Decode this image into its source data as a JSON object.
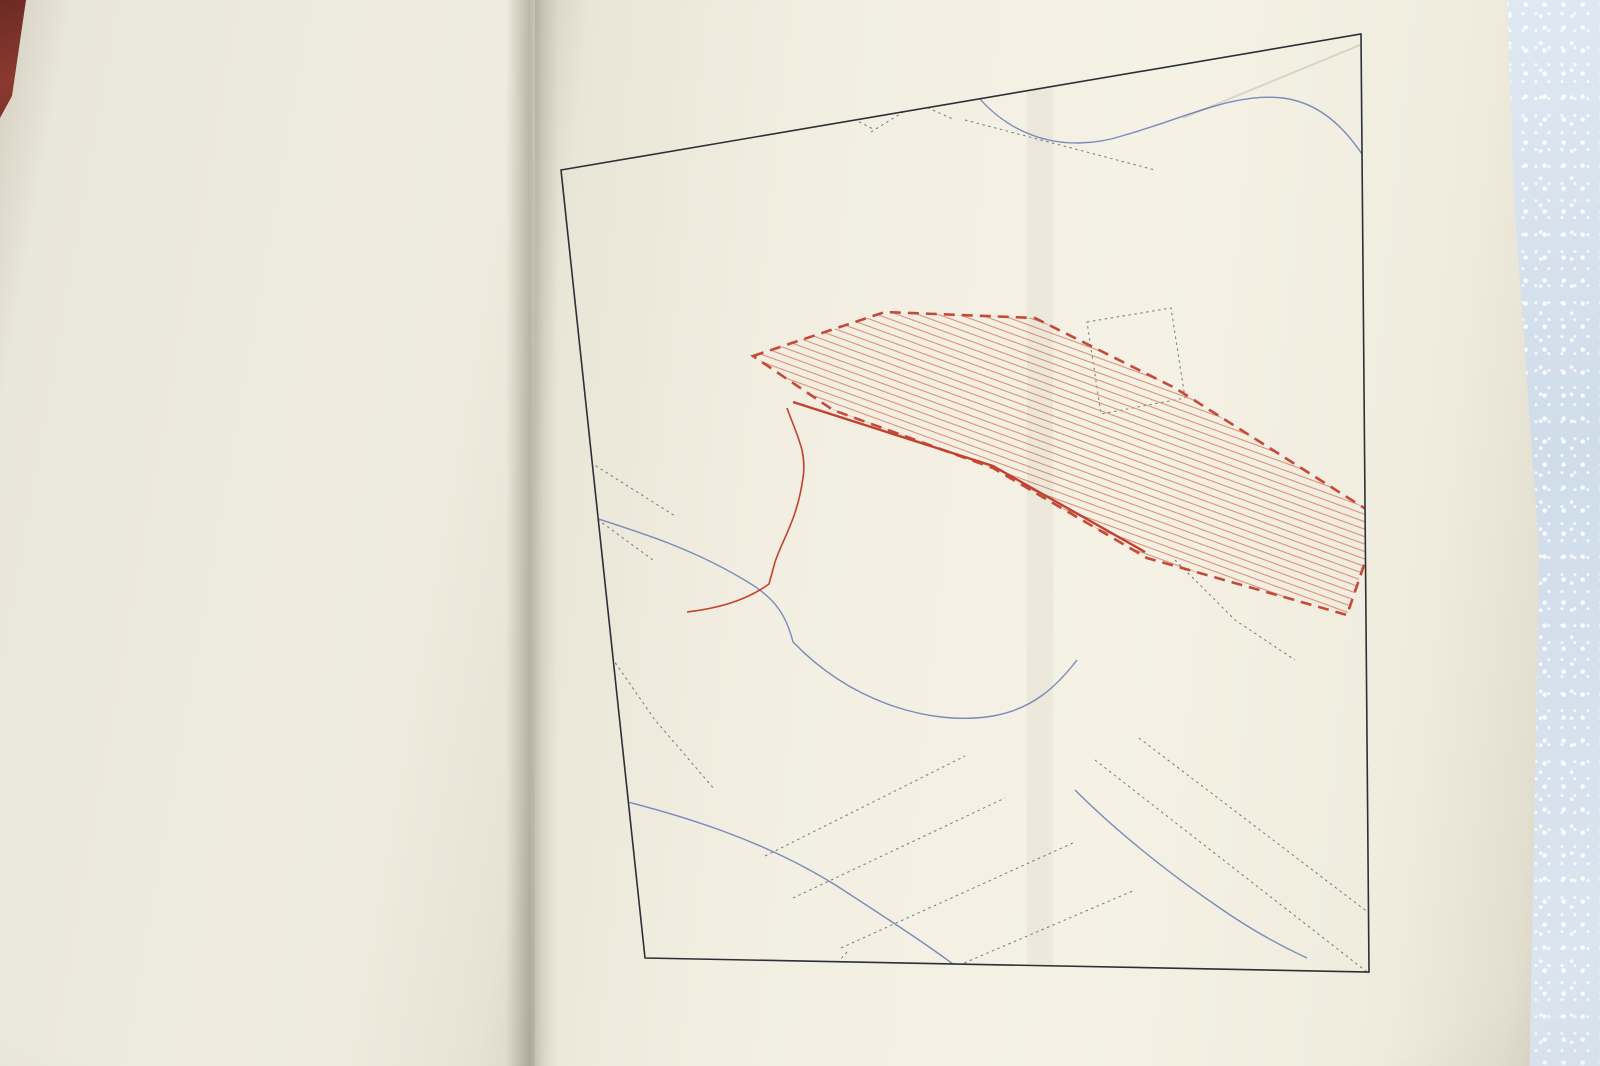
{
  "left_page": {
    "fragments": [
      {
        "t": "perméables des lass",
        "x": 372,
        "y": -2,
        "r": -25
      },
      {
        "t": "pluie tombant, par seconde, sur",
        "x": 282,
        "y": 12,
        "r": -21
      },
      {
        "t": "par cette réduction au 1/3, ou lieu",
        "x": 216,
        "y": 40,
        "r": -18
      },
      {
        "t": "une première partie de l’eau s’évapore et rem",
        "x": 74,
        "y": 46,
        "r": -13
      }
    ],
    "lines": [
      "tmosphère ou sert à la nutrition des végétaux ; de ce qu",
      "conde abreuve la terre, la traverse jusqu’à la couche imperm",
      "r laquelle elle coule pour aller dans les parties basses for",
      "s sources plus ou moins abondantes suivant l’étendue des l",
      "ns qui les alimentent ; de ce qu’enfin une troisième v′ s’éc",
      "la surface du sol dont elle gagne les points bas, en arriv",
      "core à l’égout après la fin de l’orage ; l’écoulement de la pl",
      "re, en effet, plus longtemps que sa chute.",
      "Quant aux parties imperméables, elles sont censées donner l",
      "volume d’eau v″ qu’elles reçoivent.",
      "C’est donc aux volumes réunis v′ et v″ des eaux coulant",
      "rface du sol qu’il importe de livrer passage dans les ouvra",
      "nstruire.",
      "Mais nous devons faire remarquer que, dans les questions d",
      "nre, tous les éléments d’appréciation ne sont pas faciles à",
      "ître et qu’il faut bien s’en rapporter à des observations g",
      "les pour calculer la section des égouts."
    ],
    "heading_lead": "Égout principal.",
    "heading_rest": " — Dans le cas qui nous occupe, le volum",
    "line_v": "eau total à évacuer par seconde V = v′ + v″ se calculera com",
    "line_suit": "suit :",
    "formula": {
      "lead_eq": "=",
      "brace": "{",
      "close_brace": "}",
      "rows": [
        [
          {
            "frac": [
              [
                "0",
                {
                  "sup": "mc"
                },
                ",133 × ",
                {
                  "i": "s"
                }
              ],
              [
                "3"
              ]
            ]
          },
          "  =  ",
          {
            "frac": [
              [
                "0",
                {
                  "sup": "mc"
                },
                ",133 × 6",
                {
                  "sup": "h"
                }
              ],
              [
                "3"
              ]
            ]
          },
          "  =  0",
          {
            "sup": "mc"
          },
          ",266"
        ],
        [
          "0",
          {
            "sup": "mc"
          },
          ",133 × ",
          {
            "i": "s′"
          },
          "  =  0",
          {
            "sup": "mc"
          },
          ",133 × 1",
          {
            "sup": "h"
          },
          "  =  0",
          {
            "sup": "mc"
          },
          ",133"
        ],
        [
          "0",
          {
            "sup": "mc"
          },
          ",133 × ",
          {
            "i": "s″"
          },
          "  =  0",
          {
            "sup": "mc"
          },
          ",133 × 1",
          {
            "sup": "h"
          },
          "  =  0",
          {
            "sup": "mc"
          },
          ",133  ["
        ]
      ],
      "annotations": {
        "right1": [
          "0",
          {
            "sup": "mc"
          },
          ",399 pour le côté gau"
        ],
        "right2": [
          "0",
          {
            "sup": "mc"
          },
          ",133 pour le côté dro"
        ],
        "total_label": "Volume total : V = ",
        "total_value": [
          "0",
          {
            "sup": "mc"
          },
          ",532"
        ]
      }
    },
    "bottom_lines": {
      "s1": "Supposons que l’égout soit de forme ovoïde et présen",
      "s2": "nensions cotées au croquis (fig. 37) :",
      "s3": [
        "la section supposée mouillée ",
        {
          "i": "adg"
        },
        " = 0",
        {
          "sup": "mq"
        },
        ",553 ;"
      ],
      "s4": [
        "le périmètre mouillé ",
        {
          "i": "abcdefg"
        },
        " = 2",
        {
          "sup": "m"
        },
        ",280 ;"
      ],
      "s5": [
        "=  ",
        {
          "frac": [
            [
              "0",
              {
                "sup": "mq"
              },
              ",553"
            ],
            [
              "2",
              {
                "sup": "m"
              },
              ",280"
            ]
          ]
        },
        "  =  0",
        {
          "sup": "m"
        },
        ",243 ;"
      ]
    }
  },
  "plate": {
    "plate_number": "Pl. 4.",
    "title": "DÉBOUCHÉ DES ÉGOUTS",
    "figure_label": "Fig. 36.",
    "publisher_caption": "Paris, BAUDRY & Cie, Éditeurs.",
    "printer_caption": "L. Courtier, 43, rue de Dunkerque, Paris.",
    "print_number": "17198",
    "map": {
      "basin_label": "Bassin à égoutter",
      "basin_sublabel": "Superficie totale = 8 Hectares environ",
      "aqueduct_label": "Aqueduc",
      "ink_color": "#2d333b",
      "red_color": "#c3412f",
      "blue_color": "#7186b8",
      "elevations": [
        {
          "v": "(20.20)",
          "x": 598,
          "y": 220,
          "r": -10
        },
        {
          "v": "(23.01)",
          "x": 506,
          "y": 314,
          "r": -8
        },
        {
          "v": "(19.75)",
          "x": 780,
          "y": 326,
          "r": -8
        },
        {
          "v": "(21.20)",
          "x": 230,
          "y": 348,
          "r": -8
        },
        {
          "v": "20.98",
          "x": 180,
          "y": 388,
          "r": -8
        },
        {
          "v": "(19.08)",
          "x": 352,
          "y": 378,
          "r": -8
        },
        {
          "v": "(19.53)",
          "x": 404,
          "y": 410,
          "r": 76
        },
        {
          "v": "(22.95)",
          "x": 684,
          "y": 430,
          "r": -8
        },
        {
          "v": "(28.75)",
          "x": 830,
          "y": 528,
          "r": -8
        },
        {
          "v": "(20.78)",
          "x": 624,
          "y": 566,
          "r": -16
        },
        {
          "v": "(22.50)",
          "x": 788,
          "y": 628,
          "r": -12
        },
        {
          "v": "(16.71)",
          "x": 506,
          "y": 658,
          "r": -5
        },
        {
          "v": "(15.41)",
          "x": 242,
          "y": 520,
          "r": -8
        },
        {
          "v": "(19.32)",
          "x": 160,
          "y": 610,
          "r": -8
        },
        {
          "v": "(13.50)",
          "x": 408,
          "y": 781,
          "r": -5
        }
      ],
      "street_labels": [
        {
          "t": "Rue",
          "x": 206,
          "y": 172,
          "r": 80,
          "s": 13
        },
        {
          "t": "Sentier",
          "x": 258,
          "y": 316,
          "r": -58,
          "s": 11
        },
        {
          "t": "Sentier",
          "x": 426,
          "y": 258,
          "r": 22,
          "s": 11
        },
        {
          "t": "Route",
          "x": 260,
          "y": 400,
          "r": -12,
          "s": 14
        },
        {
          "t": "Rue",
          "x": 146,
          "y": 500,
          "r": 75,
          "s": 12
        },
        {
          "t": "Nationale",
          "x": 230,
          "y": 464,
          "r": 78,
          "s": 11
        },
        {
          "t": "Nationale",
          "x": 488,
          "y": 492,
          "r": 32,
          "s": 12
        },
        {
          "t": "Chemin",
          "x": 792,
          "y": 260,
          "r": -75,
          "s": 11
        },
        {
          "t": "Chemin Vicinal",
          "x": 422,
          "y": 346,
          "r": -24,
          "s": 10
        },
        {
          "t": "Chemin",
          "x": 712,
          "y": 824,
          "r": 27,
          "s": 11
        },
        {
          "t": "Vicinal",
          "x": 770,
          "y": 868,
          "r": 27,
          "s": 11
        },
        {
          "t": "Route",
          "x": 358,
          "y": 672,
          "r": -82,
          "s": 12
        },
        {
          "t": "Boulevard",
          "x": 308,
          "y": 890,
          "r": -56,
          "s": 12
        }
      ],
      "water_labels": [
        {
          "t": "Courant",
          "x": 548,
          "y": 152,
          "r": 10
        },
        {
          "t": "Fossé",
          "x": 208,
          "y": 556,
          "r": -18
        },
        {
          "t": "Fossé",
          "x": 480,
          "y": 712,
          "r": -12
        },
        {
          "t": "Fossé",
          "x": 206,
          "y": 830,
          "r": -20
        },
        {
          "t": "Courant",
          "x": 500,
          "y": 878,
          "r": 40
        }
      ]
    }
  }
}
